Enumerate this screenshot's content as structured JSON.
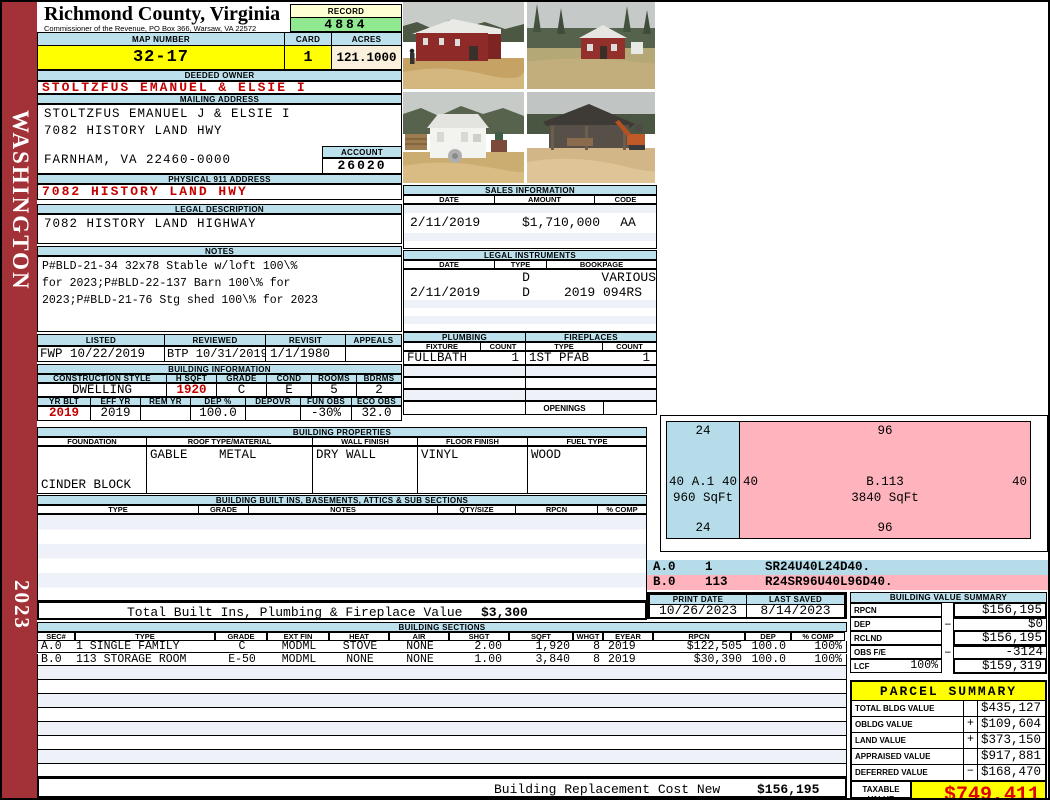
{
  "sidebar": {
    "state": "WASHINGTON",
    "year": "2023"
  },
  "header": {
    "title": "Richmond County, Virginia",
    "subtitle": "Commissioner of the Revenue, PO Box 366, Warsaw, VA 22572",
    "record_label": "RECORD",
    "record_value": "4884",
    "map_number_label": "MAP NUMBER",
    "map_number": "32-17",
    "card_label": "CARD",
    "card_value": "1",
    "acres_label": "ACRES",
    "acres_value": "121.1000"
  },
  "owner": {
    "deeded_owner_label": "DEEDED OWNER",
    "deeded_owner": "STOLTZFUS EMANUEL & ELSIE I",
    "mailing_address_label": "MAILING ADDRESS",
    "mailing_line1": "STOLTZFUS EMANUEL J & ELSIE I",
    "mailing_line2": "7082 HISTORY LAND HWY",
    "mailing_line3": "FARNHAM, VA 22460-0000",
    "account_label": "ACCOUNT",
    "account_value": "26020",
    "physical_address_label": "PHYSICAL 911 ADDRESS",
    "physical_address": "7082 HISTORY LAND HWY"
  },
  "legal_description": {
    "label": "LEGAL DESCRIPTION",
    "value": "7082 HISTORY LAND HIGHWAY"
  },
  "notes": {
    "label": "NOTES",
    "line1": "P#BLD-21-34 32x78 Stable w/loft 100\\%",
    "line2": "for 2023;P#BLD-22-137 Barn 100\\% for",
    "line3": "2023;P#BLD-21-76 Stg shed 100\\% for 2023"
  },
  "listing": {
    "headers": [
      "LISTED",
      "REVIEWED",
      "REVISIT",
      "APPEALS"
    ],
    "values": [
      "FWP 10/22/2019",
      "BTP 10/31/2019",
      "1/1/1980",
      ""
    ]
  },
  "building_info": {
    "title": "BUILDING INFORMATION",
    "row1_headers": [
      "CONSTRUCTION STYLE",
      "H SQFT",
      "GRADE",
      "COND",
      "ROOMS",
      "BDRMS"
    ],
    "row1_values": [
      "DWELLING",
      "1920",
      "C",
      "E",
      "5",
      "2"
    ],
    "row2_headers": [
      "YR BLT",
      "EFF YR",
      "REM YR",
      "DEP %",
      "DEPOVR",
      "FUN OBS",
      "ECO OBS"
    ],
    "row2_values": [
      "2019",
      "2019",
      "",
      "100.0",
      "",
      "-30%",
      "32.0"
    ]
  },
  "building_properties": {
    "title": "BUILDING PROPERTIES",
    "headers": [
      "FOUNDATION",
      "ROOF TYPE/MATERIAL",
      "WALL FINISH",
      "FLOOR FINISH",
      "FUEL TYPE"
    ],
    "foundation_line1": "CINDER BLOCK",
    "foundation_line2": "CRAWL",
    "roof_type": "GABLE",
    "roof_material": "METAL",
    "wall_finish": "DRY WALL",
    "floor_finish": "VINYL",
    "fuel_type": "WOOD"
  },
  "built_ins": {
    "title": "BUILDING BUILT INS, BASEMENTS, ATTICS & SUB SECTIONS",
    "headers": [
      "TYPE",
      "GRADE",
      "NOTES",
      "QTY/SIZE",
      "RPCN",
      "% COMP"
    ]
  },
  "totals": {
    "built_ins_label": "Total Built Ins, Plumbing & Fireplace Value",
    "built_ins_value": "$3,300",
    "replacement_label": "Building Replacement Cost New",
    "replacement_value": "$156,195"
  },
  "sales": {
    "title": "SALES INFORMATION",
    "headers": [
      "DATE",
      "AMOUNT",
      "CODE"
    ],
    "row": [
      "2/11/2019",
      "$1,710,000",
      "AA"
    ]
  },
  "legal_instruments": {
    "title": "LEGAL INSTRUMENTS",
    "headers": [
      "DATE",
      "TYPE",
      "BOOKPAGE"
    ],
    "rows": [
      [
        "",
        "D",
        "VARIOUS"
      ],
      [
        "2/11/2019",
        "D",
        "2019 094RS"
      ]
    ]
  },
  "plumbing": {
    "title": "PLUMBING",
    "headers": [
      "FIXTURE",
      "COUNT"
    ],
    "row": [
      "FULLBATH",
      "1"
    ]
  },
  "fireplaces": {
    "title": "FIREPLACES",
    "headers": [
      "TYPE",
      "COUNT"
    ],
    "row": [
      "1ST PFAB",
      "1"
    ],
    "openings_label": "OPENINGS"
  },
  "sketch": {
    "a": {
      "top": "24",
      "bottom": "24",
      "left": "40",
      "right": "40",
      "label": "A.1",
      "sqft": "960 SqFt"
    },
    "b": {
      "top": "96",
      "bottom": "96",
      "left": "40",
      "right": "40",
      "label": "B.113",
      "sqft": "3840 SqFt"
    },
    "spec_a": {
      "sec": "A.0",
      "num": "1",
      "code": "SR24U40L24D40."
    },
    "spec_b": {
      "sec": "B.0",
      "num": "113",
      "code": "R24SR96U40L96D40."
    }
  },
  "print_info": {
    "print_date_label": "PRINT DATE",
    "print_date": "10/26/2023",
    "last_saved_label": "LAST SAVED",
    "last_saved": "8/14/2023"
  },
  "building_value_summary": {
    "title": "BUILDING VALUE SUMMARY",
    "rows": [
      {
        "label": "RPCN",
        "pct": "",
        "op": "",
        "value": "$156,195"
      },
      {
        "label": "DEP",
        "pct": "",
        "op": "−",
        "value": "$0"
      },
      {
        "label": "RCLND",
        "pct": "",
        "op": "",
        "value": "$156,195"
      },
      {
        "label": "OBS F/E",
        "pct": "",
        "op": "−",
        "value": "-3124"
      },
      {
        "label": "LCF",
        "pct": "100%",
        "op": "",
        "value": "$159,319"
      }
    ]
  },
  "building_sections": {
    "title": "BUILDING SECTIONS",
    "headers": [
      "SEC#",
      "TYPE",
      "GRADE",
      "EXT FIN",
      "HEAT",
      "AIR",
      "SHGT",
      "SQFT",
      "WHGT",
      "EYEAR",
      "RPCN",
      "DEP",
      "% COMP"
    ],
    "rows": [
      [
        "A.0",
        "1 SINGLE FAMILY",
        "C",
        "MODML",
        "STOVE",
        "NONE",
        "2.00",
        "1,920",
        "8",
        "2019",
        "$122,505",
        "100.0",
        "100%"
      ],
      [
        "B.0",
        "113 STORAGE ROOM",
        "E-50",
        "MODML",
        "NONE",
        "NONE",
        "1.00",
        "3,840",
        "8",
        "2019",
        "$30,390",
        "100.0",
        "100%"
      ]
    ]
  },
  "parcel_summary": {
    "title": "PARCEL SUMMARY",
    "rows": [
      {
        "label": "TOTAL BLDG VALUE",
        "op": "",
        "value": "$435,127"
      },
      {
        "label": "OBLDG VALUE",
        "op": "+",
        "value": "$109,604"
      },
      {
        "label": "LAND VALUE",
        "op": "+",
        "value": "$373,150"
      },
      {
        "label": "APPRAISED VALUE",
        "op": "",
        "value": "$917,881"
      },
      {
        "label": "DEFERRED VALUE",
        "op": "−",
        "value": "$168,470"
      }
    ],
    "taxable_label_line1": "TAXABLE",
    "taxable_label_line2": "VALUE",
    "taxable_value": "$749,411"
  },
  "colors": {
    "sidebar_red": "#A33238",
    "header_blue": "#BCE0EC",
    "highlight_yellow": "#FFFF00",
    "record_green": "#90E890",
    "sketch_blue": "#B5DCE8",
    "sketch_pink": "#FFB3BD",
    "value_red": "#CC0000"
  }
}
